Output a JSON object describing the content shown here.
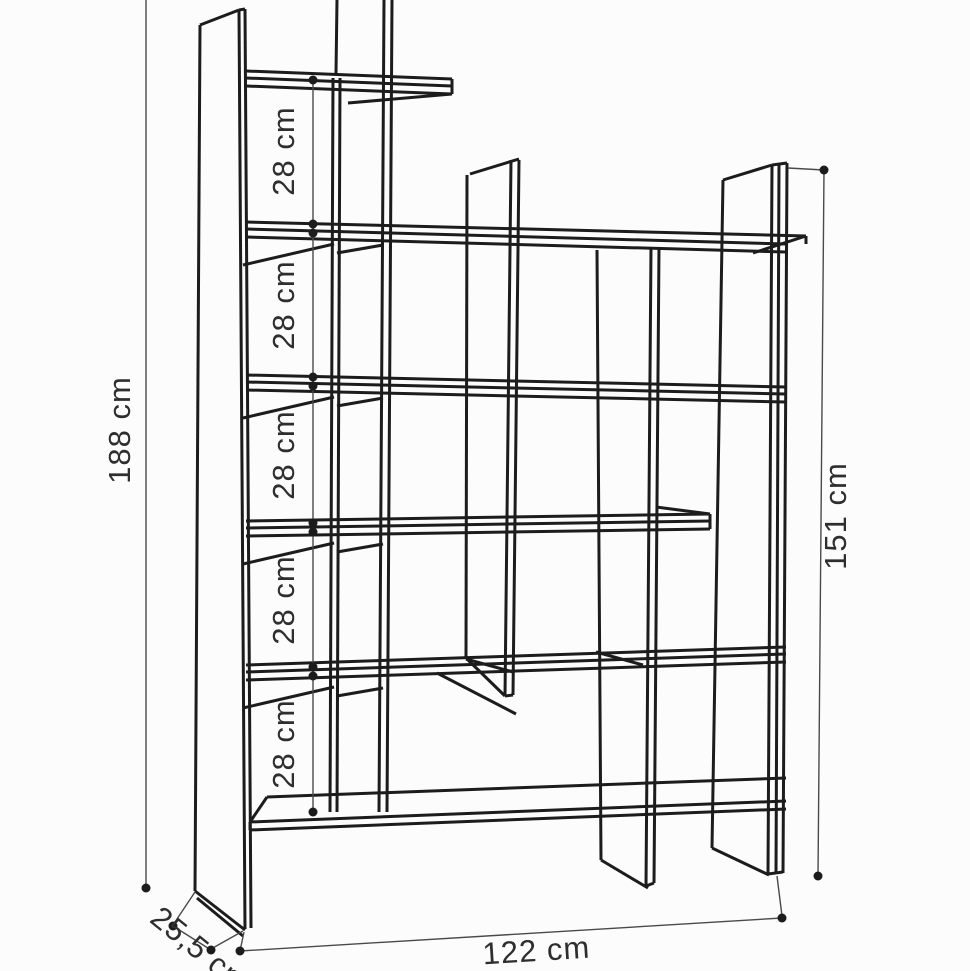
{
  "diagram": {
    "type": "furniture-dimension-drawing",
    "subject": "staggered open bookshelf, perspective line drawing",
    "labels": {
      "overall_height": "188 cm",
      "inner_height": "151 cm",
      "width": "122 cm",
      "depth": "25,5 cm",
      "shelf_gaps": [
        "28 cm",
        "28 cm",
        "28 cm",
        "28 cm",
        "28 cm"
      ]
    },
    "colors": {
      "background": "#fcfcfc",
      "structure_line": "#1c1c1c",
      "dimension_line": "#4a4a4a",
      "label_text": "#2e2e2e"
    }
  }
}
